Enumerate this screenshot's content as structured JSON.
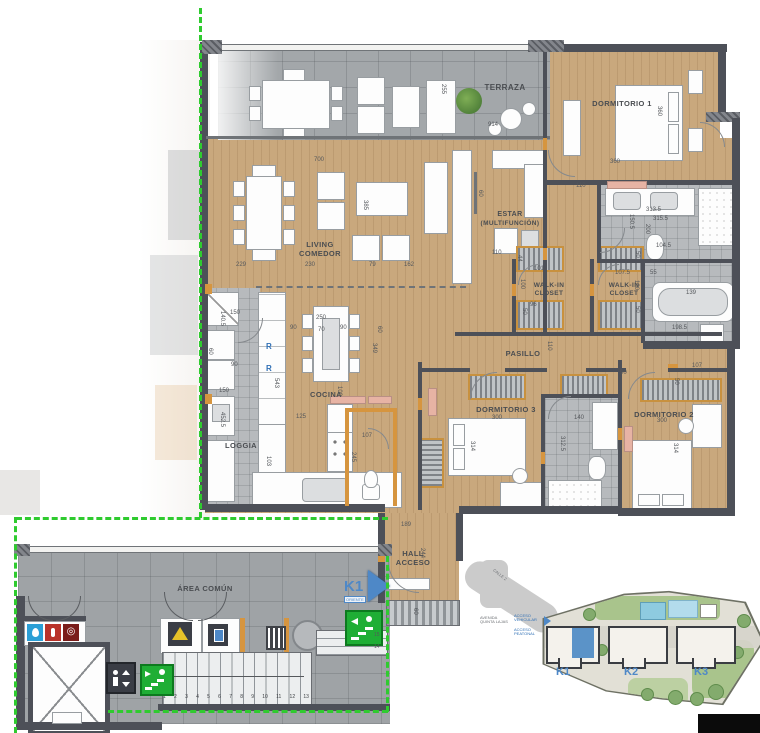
{
  "rooms": [
    {
      "label": "TERRAZA"
    },
    {
      "label": "DORMITORIO 1"
    },
    {
      "label": "LIVING",
      "label2": "COMEDOR"
    },
    {
      "label": "ESTAR",
      "label2": "(MULTIFUNCIÓN)"
    },
    {
      "label": "WALK-IN",
      "label2": "CLOSET"
    },
    {
      "label": "WALK-IN",
      "label2": "CLOSET"
    },
    {
      "label": "PASILLO"
    },
    {
      "label": "COCINA"
    },
    {
      "label": "LOGGIA"
    },
    {
      "label": "DORMITORIO 3"
    },
    {
      "label": "DORMITORIO 2"
    },
    {
      "label": "HALL",
      "label2": "ACCESO"
    },
    {
      "label": "ÁREA COMÚN"
    }
  ],
  "unit_marker": {
    "label": "K1",
    "sub": "ORIENTE"
  },
  "appliances": {
    "refrigerator_mark": "R"
  },
  "dims": [
    "914",
    "700",
    "255",
    "360",
    "360",
    "110",
    "229",
    "230",
    "79",
    "162",
    "385",
    "60",
    "110",
    "44",
    "100",
    "101",
    "313.5",
    "315.5",
    "150.5",
    "200",
    "104.5",
    "107.5",
    "55",
    "50",
    "100",
    "50",
    "139",
    "198.5",
    "96",
    "50",
    "110",
    "90",
    "50",
    "107",
    "250",
    "70",
    "90",
    "90",
    "60",
    "349",
    "150",
    "140.5",
    "60",
    "90",
    "150",
    "543",
    "452.5",
    "125",
    "103",
    "107",
    "245",
    "100",
    "300",
    "314",
    "140",
    "312.5",
    "300",
    "314",
    "189",
    "244",
    "60"
  ],
  "stairs": {
    "steps": [
      "1",
      "2",
      "3",
      "4",
      "5",
      "6",
      "7",
      "8",
      "9",
      "10",
      "11",
      "12",
      "13"
    ],
    "upper": [
      "15",
      "14"
    ]
  },
  "site_plan": {
    "road": "CALLE 2",
    "avenue": "AVENIDA QUINTA LAJAS",
    "access_vehicular": "ACCESO VEHICULAR",
    "access_peatonal": "ACCESO PEATONAL",
    "buildings": [
      {
        "label": "K1"
      },
      {
        "label": "K2"
      },
      {
        "label": "K3"
      }
    ]
  },
  "colors": {
    "accent_blue": "#4e88c7",
    "exit_green": "#1fae35",
    "dash_green": "#2fcb2f",
    "wood": "#c9a87d",
    "wall": "#4d5058",
    "wood_trim": "#d6953f"
  }
}
